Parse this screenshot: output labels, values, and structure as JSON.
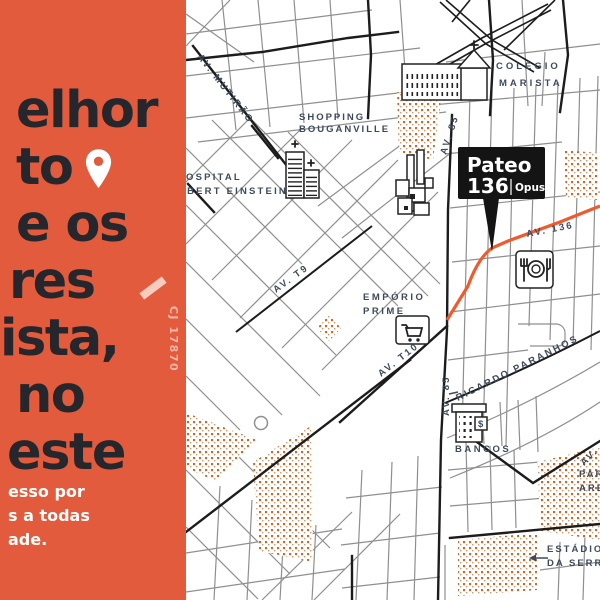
{
  "panel": {
    "bg_color": "#E25B3C",
    "headline": [
      "elhor",
      "to",
      "e os",
      "res",
      "ista,",
      "no",
      "este"
    ],
    "subtext": [
      "esso por",
      "s a todas",
      "ade."
    ],
    "vertical_code": "CJ 17870"
  },
  "marker": {
    "name": "Pateo",
    "number": "136",
    "brand": "Opus."
  },
  "map": {
    "colors": {
      "route": "#F15B2B",
      "stipple": "#BE6F2F",
      "label": "#3D4A5C"
    },
    "labels": {
      "av_mutirao": "AV. MUTIRÃO",
      "shopping1": "SHOPPING",
      "shopping2": "BOUGANVILLE",
      "hospital1": "HOSPITAL",
      "hospital2": "ALBERT EINSTEIN",
      "colegio1": "COLÉGIO",
      "colegio2": "MARISTA",
      "av85_top": "AV. 85",
      "av136": "AV. 136",
      "emporio1": "EMPÓRIO",
      "emporio2": "PRIME",
      "av_t9": "AV. T9",
      "av_t10": "AV. T10",
      "av85_mid": "AV. 85",
      "ricardo": "RICARDO PARANHOS",
      "bancos": "BANCOS",
      "estadio1": "ESTÁDIO",
      "estadio2": "DA SERRINHA",
      "parque1": "PARQUE",
      "parque2": "AREIÃO",
      "av_edge": "AV.",
      "dollar": "$"
    }
  }
}
